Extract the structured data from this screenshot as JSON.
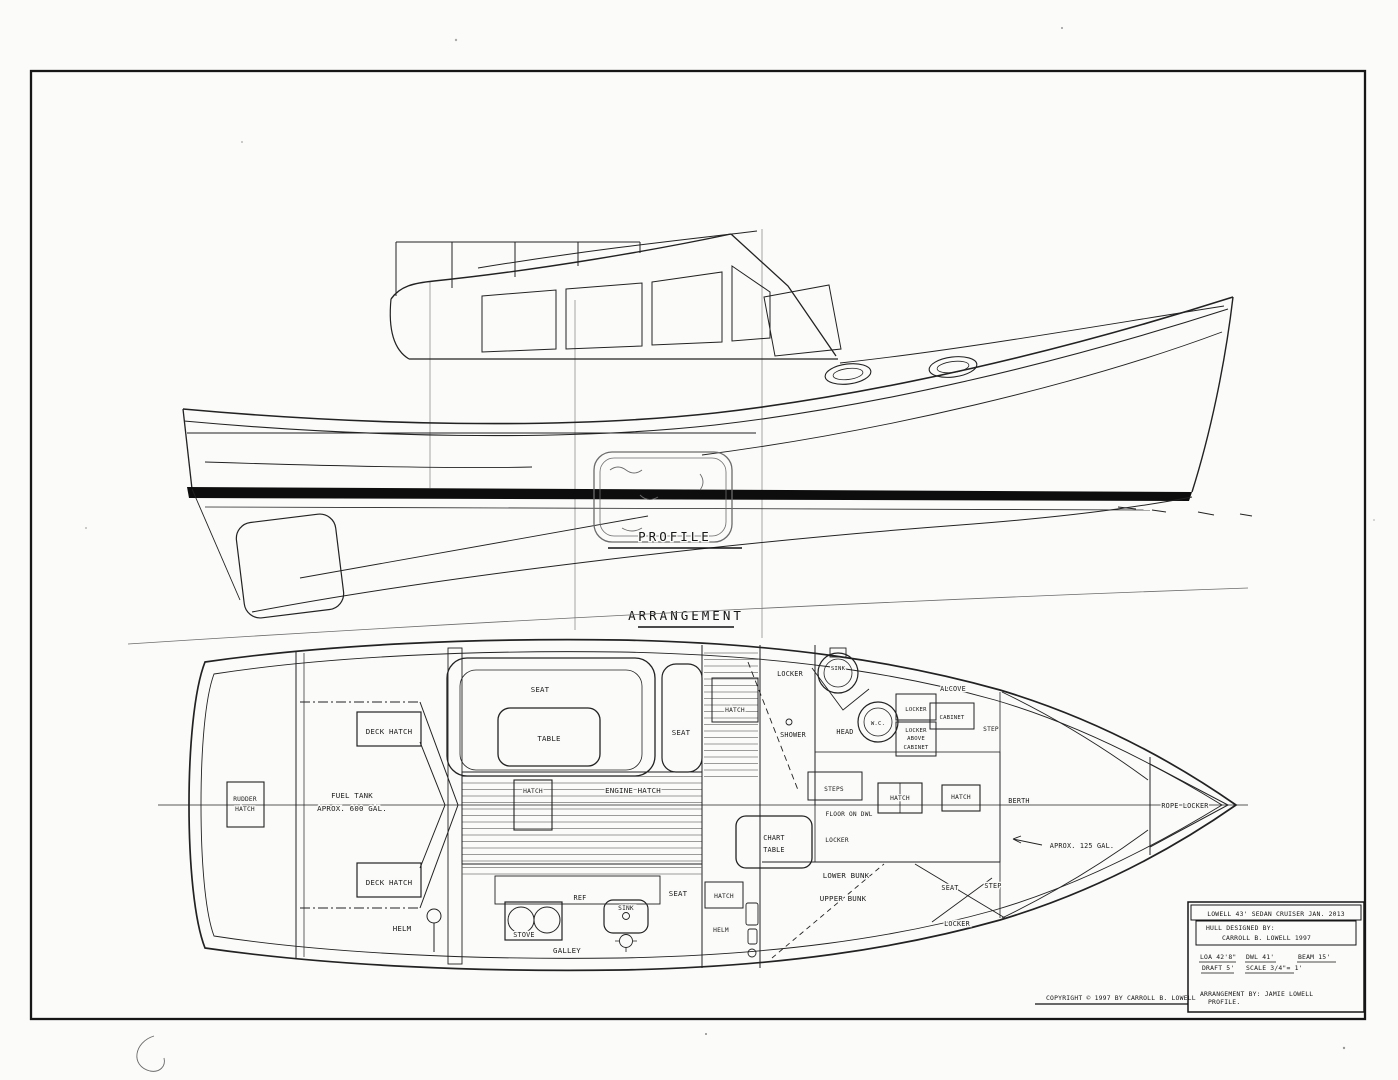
{
  "profile": {
    "title": "PROFILE"
  },
  "arrangement": {
    "title": "ARRANGEMENT",
    "labels": {
      "rudder_hatch_line1": "RUDDER",
      "rudder_hatch_line2": "HATCH",
      "deck_hatch_aft": "DECK HATCH",
      "deck_hatch_fwd": "DECK HATCH",
      "fuel_tank_line1": "FUEL TANK",
      "fuel_tank_line2": "APROX. 600 GAL.",
      "helm_port": "HELM",
      "seat_saloon": "SEAT",
      "table": "TABLE",
      "seat_starboard": "SEAT",
      "hatch_saloon": "HATCH",
      "engine_hatch": "ENGINE HATCH",
      "ref": "REF",
      "stove": "STOVE",
      "galley": "GALLEY",
      "sink_galley": "SINK",
      "seat_aft": "SEAT",
      "hatch_cockpit": "HATCH",
      "helm_starboard": "HELM",
      "chart_table_line1": "CHART",
      "chart_table_line2": "TABLE",
      "locker_aft": "LOCKER",
      "sink_head": "SINK",
      "hatch_head": "HATCH",
      "shower": "SHOWER",
      "head": "HEAD",
      "wc": "W.C.",
      "locker_head": "LOCKER",
      "locker_above_line1": "LOCKER",
      "locker_above_line2": "ABOVE",
      "locker_above_line3": "CABINET",
      "alcove": "ALCOVE",
      "cabinet": "CABINET",
      "step_head": "STEP",
      "steps": "STEPS",
      "floor_on_dwl": "FLOOR ON DWL",
      "locker_mid": "LOCKER",
      "hatch_fwd_port": "HATCH",
      "hatch_fwd_stbd": "HATCH",
      "berth": "BERTH",
      "water_tank": "APROX. 125 GAL.",
      "lower_bunk": "LOWER BUNK",
      "upper_bunk": "UPPER BUNK",
      "seat_fwd": "SEAT",
      "step_fwd": "STEP",
      "locker_fwd": "LOCKER",
      "rope_locker": "ROPE LOCKER"
    }
  },
  "title_block": {
    "line1": "LOWELL 43' SEDAN CRUISER JAN. 2013",
    "line2": "HULL DESIGNED BY:",
    "line3": "CARROLL B. LOWELL 1997",
    "loa": "LOA 42'8\"",
    "dwl": "DWL 41'",
    "beam": "BEAM 15'",
    "draft": "DRAFT 5'",
    "scale": "SCALE 3/4\"= 1'",
    "credit": "ARRANGEMENT BY: JAMIE LOWELL",
    "credit2": "PROFILE."
  },
  "copyright": "COPYRIGHT © 1997 BY CARROLL B. LOWELL"
}
